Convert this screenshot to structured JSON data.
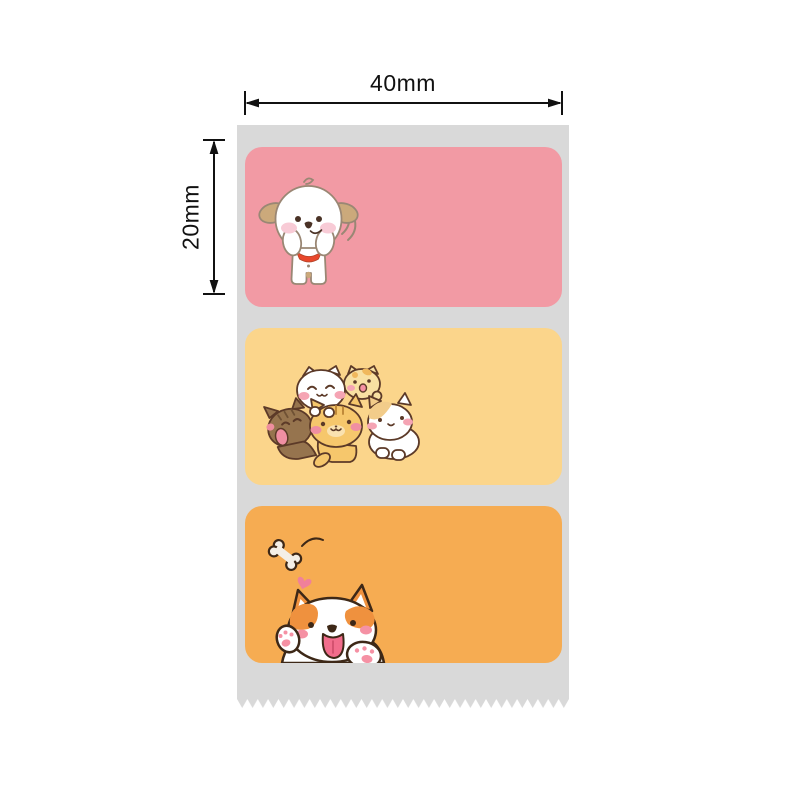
{
  "page": {
    "background": "#FFFFFF",
    "content": "product-diagram-of-thermal-label-roll"
  },
  "dimension_annotations": {
    "width": {
      "label": "40mm"
    },
    "height": {
      "label": "20mm"
    },
    "line_color": "#111111"
  },
  "label_roll": {
    "backing_color": "#D9D9D9",
    "tear_edge": "zigzag-serrated-bottom",
    "labels": [
      {
        "id": "puppy-label",
        "background": "#F29AA4",
        "illustration": "white-puppy-cheering-with-red-collar"
      },
      {
        "id": "cats-label",
        "background": "#FBD58B",
        "illustration": "pile-of-five-kittens"
      },
      {
        "id": "corgi-label",
        "background": "#F6AC52",
        "illustration": "corgi-waving-with-flying-bone-and-heart"
      }
    ]
  }
}
